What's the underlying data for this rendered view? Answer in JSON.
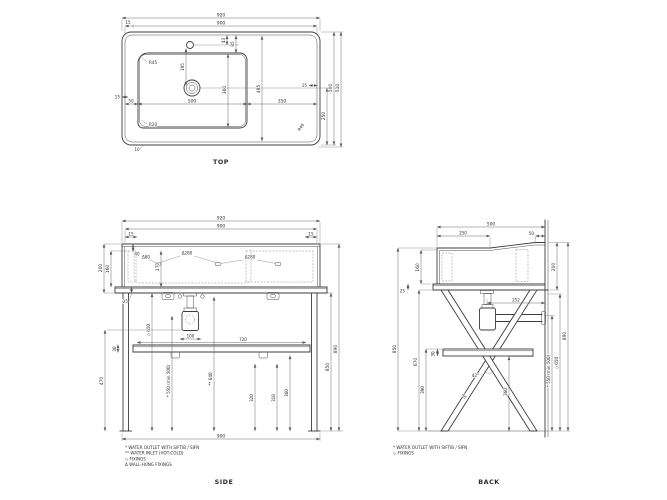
{
  "drawing": {
    "background": "#ffffff",
    "line_color": "#3c3c3c",
    "dim_color": "#5a5a5a"
  },
  "views": {
    "top": {
      "label": "TOP",
      "overall_width": "920",
      "usable_width": "900",
      "top_gap": "15",
      "tap_offset_a": "43",
      "tap_offset_b": "85",
      "bowl_radius_top": "R45",
      "bowl_radius_bottom": "R20",
      "tap_to_drain": "195",
      "bowl_depth": "360",
      "deck_inner_depth": "485",
      "left_margin": "50",
      "bowl_width": "500",
      "right_deck": "350",
      "left_gap": "15",
      "right_gap": "15",
      "bottom_lip": "10",
      "drain_from_front": "250",
      "depth": "500",
      "overall_depth": "510",
      "corner_radius": "R46"
    },
    "side": {
      "label": "SIDE",
      "overall_width": "920",
      "usable_width": "900",
      "gap_left": "15",
      "gap_right": "15",
      "basin_height": "200",
      "basin_inner_height": "160",
      "rim_height": "40",
      "drain_inset": "170",
      "fixing_a": "Δ80",
      "fixing_b": "Δ280",
      "fixing_c": "Δ280",
      "deck_thickness": "25",
      "fixings_height": "◇ 650",
      "outlet_height": "* 550 (min 500)",
      "inlet_height": "** 640",
      "trap_offset": "100",
      "shelf_length": "720",
      "shelf_thickness": "30",
      "trap_height": "470",
      "pipe_height_a": "320",
      "pipe_height_b": "318",
      "pipe_height_c": "360",
      "legs_height": "850",
      "total_height": "890",
      "floor_width": "900",
      "legend": [
        "* WATER OUTLET WITH SIFTIB / SIFN",
        "** WATER INLET  (HOT-COLD)",
        "◇ FIXINGS",
        "Δ WALL-HUNG FIXINGS"
      ]
    },
    "back": {
      "label": "BACK",
      "depth": "500",
      "front_flat": "250",
      "back_lip": "50",
      "basin_inner_height": "160",
      "basin_height": "200",
      "deck_thickness": "25",
      "pipe_to_wall": "252",
      "shelf_thickness": "30",
      "front_height": "850",
      "under_deck_height": "670",
      "shelf_top_height": "390",
      "shelf_bottom_height": "360",
      "leg_angle": "42°",
      "leg_width": "40",
      "outlet_height": "* 550 (min 500)",
      "fixings_height": "◇ 650",
      "total_height": "890",
      "legend": [
        "* WATER OUTLET WITH SIFTIB / SIFN",
        "◇ FIXINGS"
      ]
    }
  }
}
